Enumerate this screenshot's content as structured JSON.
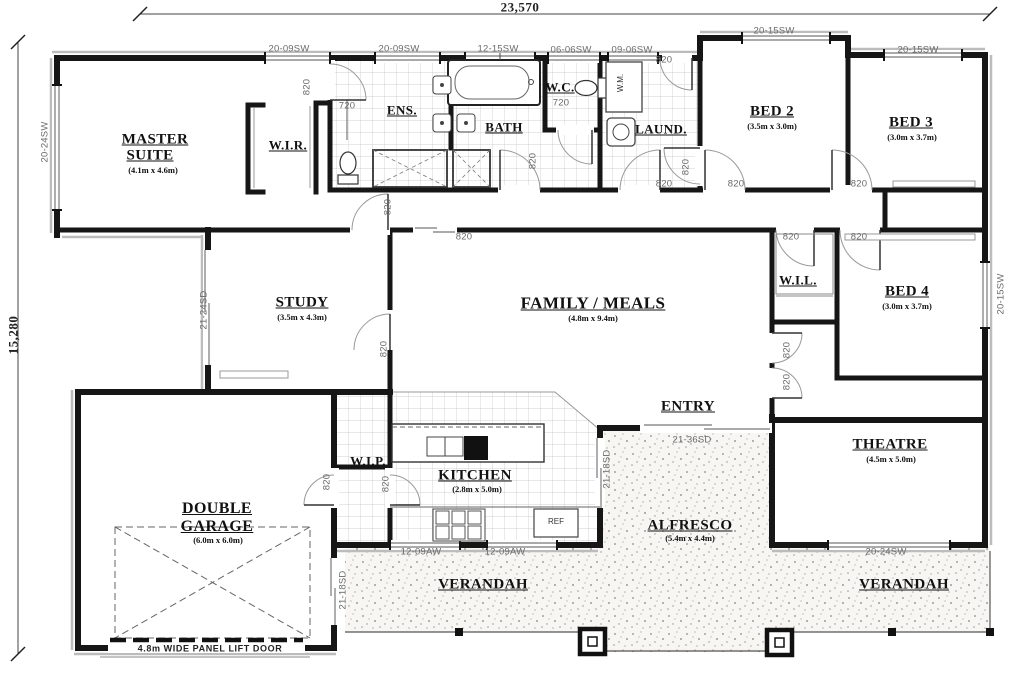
{
  "overall_dimensions": {
    "width": "23,570",
    "height": "15,280"
  },
  "rooms": {
    "master": {
      "line1": "MASTER",
      "line2": "SUITE",
      "size": "(4.1m x 4.6m)"
    },
    "wir": {
      "name": "W.I.R."
    },
    "ens": {
      "name": "ENS."
    },
    "bath": {
      "name": "BATH"
    },
    "wc": {
      "name": "W.C."
    },
    "laundry": {
      "name": "LAUND."
    },
    "bed2": {
      "name": "BED 2",
      "size": "(3.5m x 3.0m)"
    },
    "bed3": {
      "name": "BED 3",
      "size": "(3.0m x 3.7m)"
    },
    "bed4": {
      "name": "BED 4",
      "size": "(3.0m x 3.7m)"
    },
    "wil": {
      "name": "W.I.L."
    },
    "study": {
      "name": "STUDY",
      "size": "(3.5m x 4.3m)"
    },
    "family": {
      "name": "FAMILY / MEALS",
      "size": "(4.8m x 9.4m)"
    },
    "entry": {
      "name": "ENTRY"
    },
    "theatre": {
      "name": "THEATRE",
      "size": "(4.5m x 5.0m)"
    },
    "wip": {
      "name": "W.I.P."
    },
    "kitchen": {
      "name": "KITCHEN",
      "size": "(2.8m x 5.0m)"
    },
    "garage": {
      "line1": "DOUBLE",
      "line2": "GARAGE",
      "size": "(6.0m x 6.0m)"
    },
    "alfresco": {
      "name": "ALFRESCO",
      "size": "(5.4m x 4.4m)"
    },
    "verandah_left": {
      "name": "VERANDAH"
    },
    "verandah_right": {
      "name": "VERANDAH"
    }
  },
  "window_labels": {
    "w1": "20-09SW",
    "w2": "20-09SW",
    "w3": "12-15SW",
    "w4": "06-06SW",
    "w5": "09-06SW",
    "w6": "20-15SW",
    "w7": "20-15SW",
    "w8": "20-24SW",
    "w9": "21-24SD",
    "w10": "20-15SW",
    "w11": "12-09AW",
    "w12": "12-09AW",
    "w13": "20-24SW",
    "w14": "21-36SD",
    "w15": "21-18SD",
    "w16": "21-18SD"
  },
  "door_labels": {
    "d1": "820",
    "d2": "720",
    "d3": "720",
    "d4": "820",
    "d5": "820",
    "d6": "820",
    "d7": "820",
    "d8": "820",
    "d9": "820",
    "d10": "820",
    "d11": "820",
    "d12": "820",
    "d13": "820",
    "d14": "820",
    "d15": "820",
    "d16": "820",
    "d17": "820",
    "d18": "820"
  },
  "fixtures": {
    "washing_machine": "W.M.",
    "fridge": "REF"
  },
  "garage_door_label": "4.8m WIDE PANEL LIFT DOOR"
}
